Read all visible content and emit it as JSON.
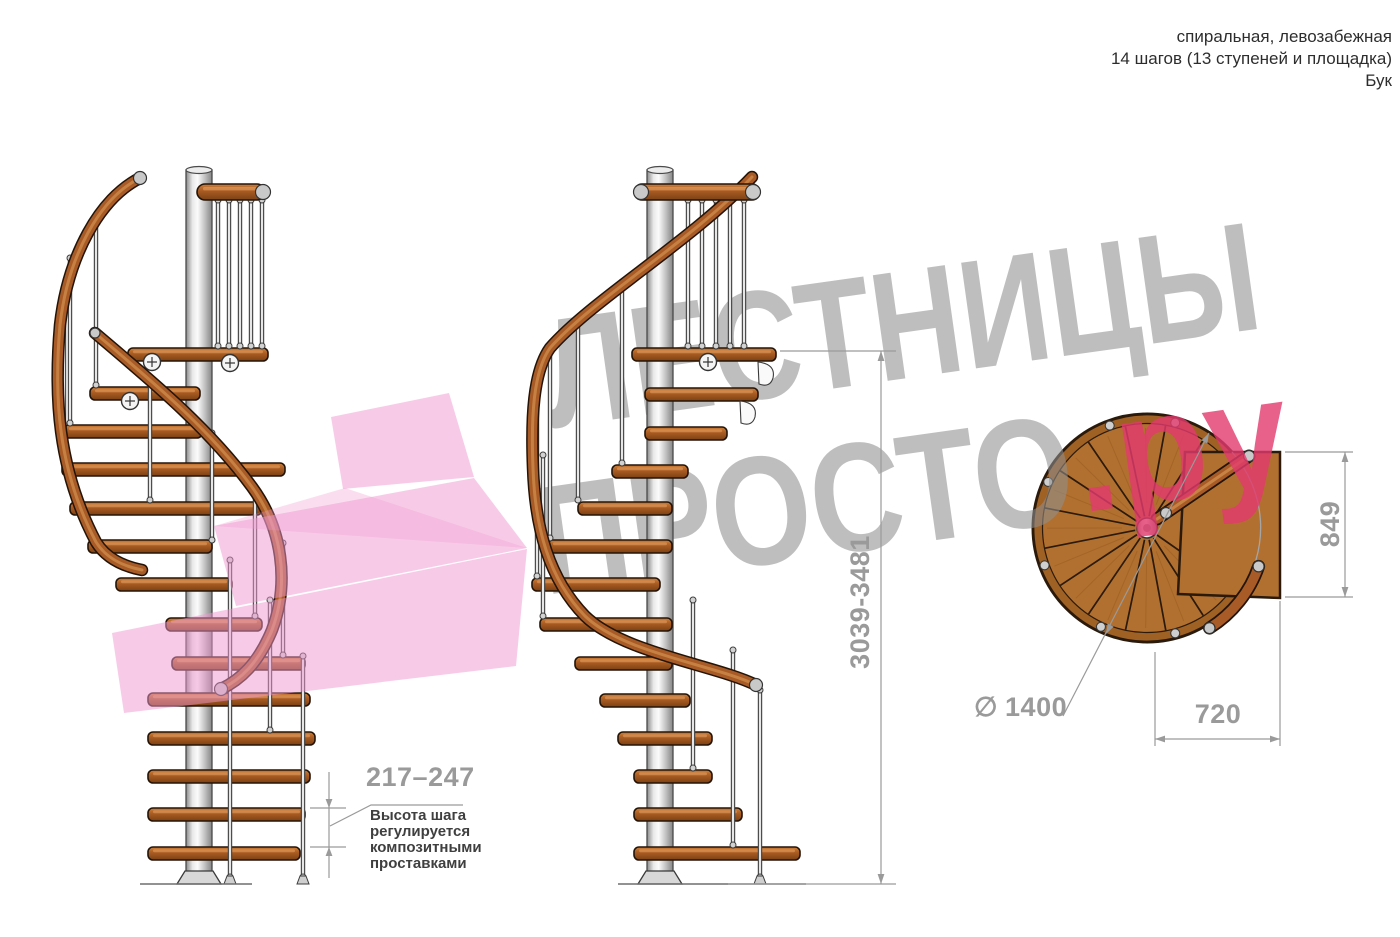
{
  "header": {
    "line1": "спиральная, левозабежная",
    "line2": "14 шагов (13 ступеней и площадка)",
    "line3": "Бук"
  },
  "watermark": {
    "word1": "ЛЕСТНИЦЫ",
    "word2": "ПРОСТО",
    "domain_suffix": ".ру"
  },
  "dimensions": {
    "step_height": "217–247",
    "step_height_note": "Высота шага регулируется композитными проставками",
    "total_height": "3039-3481",
    "landing_depth": "849",
    "landing_width": "720",
    "diameter_symbol": "∅",
    "diameter_value": "1400"
  },
  "colors": {
    "wood": "#a85b26",
    "step_wood": "#b1702f",
    "metal": "#d9d9d9",
    "watermark_gray": "#8f8f8f",
    "watermark_pink": "#e23a6e",
    "shape_pink": "#ef97cf",
    "dimension_gray": "#9a9a9a"
  }
}
